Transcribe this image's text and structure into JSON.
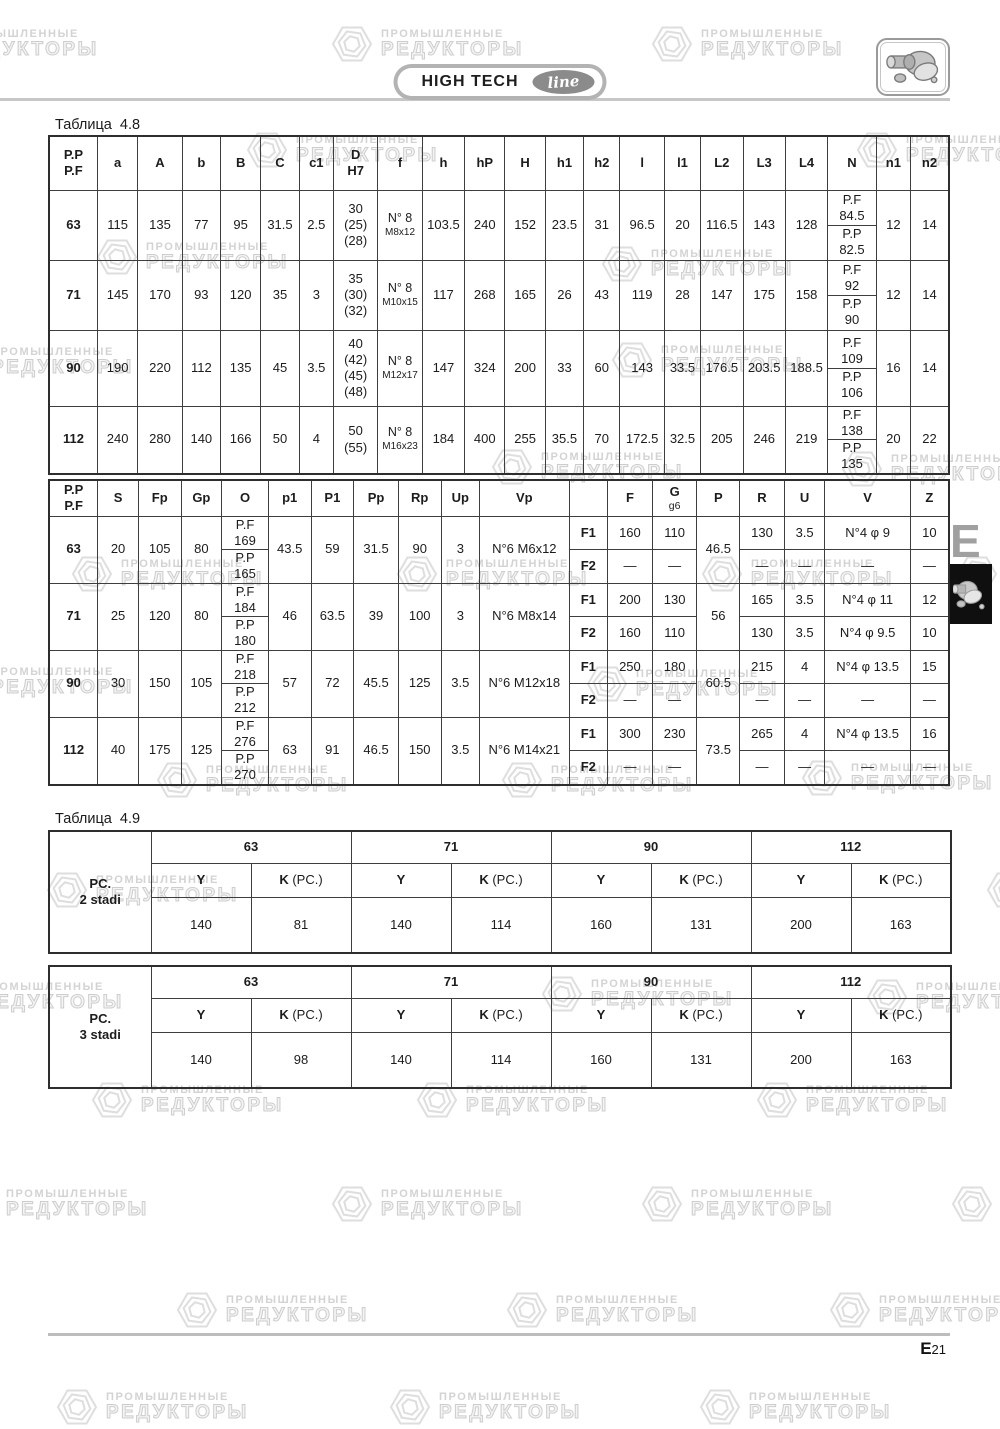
{
  "page": {
    "brand": {
      "title": "HIGH TECH",
      "script": "line"
    },
    "side_tab": {
      "letter": "E"
    },
    "footer": {
      "page_letter": "E",
      "page_number": "21"
    },
    "watermark": {
      "line1": "ПРОМЫШЛЕННЫЕ",
      "line2": "РЕДУКТОРЫ"
    }
  },
  "table48": {
    "label": "Таблица  4.8",
    "headers": [
      "P.P\nP.F",
      "a",
      "A",
      "b",
      "B",
      "C",
      "c1",
      "D\nH7",
      "f",
      "h",
      "hP",
      "H",
      "h1",
      "h2",
      "l",
      "l1",
      "L2",
      "L3",
      "L4",
      "N",
      "n1",
      "n2"
    ],
    "rows": [
      {
        "size": "63",
        "a": "115",
        "A": "135",
        "b": "77",
        "B": "95",
        "C": "31.5",
        "c1": "2.5",
        "D": "30\n(25)\n(28)",
        "f_main": "N° 8",
        "f_sub": "M8x12",
        "h": "103.5",
        "hP": "240",
        "H": "152",
        "h1": "23.5",
        "h2": "31",
        "l": "96.5",
        "l1": "20",
        "L2": "116.5",
        "L3": "143",
        "L4": "128",
        "N_top": "P.F\n84.5",
        "N_bottom": "P.P\n82.5",
        "n1": "12",
        "n2": "14"
      },
      {
        "size": "71",
        "a": "145",
        "A": "170",
        "b": "93",
        "B": "120",
        "C": "35",
        "c1": "3",
        "D": "35\n(30)\n(32)",
        "f_main": "N° 8",
        "f_sub": "M10x15",
        "h": "117",
        "hP": "268",
        "H": "165",
        "h1": "26",
        "h2": "43",
        "l": "119",
        "l1": "28",
        "L2": "147",
        "L3": "175",
        "L4": "158",
        "N_top": "P.F\n92",
        "N_bottom": "P.P\n90",
        "n1": "12",
        "n2": "14"
      },
      {
        "size": "90",
        "a": "190",
        "A": "220",
        "b": "112",
        "B": "135",
        "C": "45",
        "c1": "3.5",
        "D": "40\n(42)\n(45)\n(48)",
        "f_main": "N° 8",
        "f_sub": "M12x17",
        "h": "147",
        "hP": "324",
        "H": "200",
        "h1": "33",
        "h2": "60",
        "l": "143",
        "l1": "33.5",
        "L2": "176.5",
        "L3": "203.5",
        "L4": "188.5",
        "N_top": "P.F\n109",
        "N_bottom": "P.P\n106",
        "n1": "16",
        "n2": "14"
      },
      {
        "size": "112",
        "a": "240",
        "A": "280",
        "b": "140",
        "B": "166",
        "C": "50",
        "c1": "4",
        "D": "50\n(55)",
        "f_main": "N° 8",
        "f_sub": "M16x23",
        "h": "184",
        "hP": "400",
        "H": "255",
        "h1": "35.5",
        "h2": "70",
        "l": "172.5",
        "l1": "32.5",
        "L2": "205",
        "L3": "246",
        "L4": "219",
        "N_top": "P.F\n138",
        "N_bottom": "P.P\n135",
        "n1": "20",
        "n2": "22"
      }
    ]
  },
  "table48b": {
    "headers": [
      "P.P\nP.F",
      "S",
      "Fp",
      "Gp",
      "O",
      "p1",
      "P1",
      "Pp",
      "Rp",
      "Up",
      "Vp",
      "",
      "F",
      "G\ng6",
      "P",
      "R",
      "U",
      "V",
      "Z"
    ],
    "rows": [
      {
        "size": "63",
        "S": "20",
        "Fp": "105",
        "Gp": "80",
        "O_top": "P.F\n169",
        "O_bottom": "P.P\n165",
        "p1": "43.5",
        "P1": "59",
        "Pp": "31.5",
        "Rp": "90",
        "Up": "3",
        "Vp": "N°6 M6x12",
        "P": "46.5",
        "F1": {
          "label": "F1",
          "F": "160",
          "G": "110",
          "R": "130",
          "U": "3.5",
          "V": "N°4 φ 9",
          "Z": "10"
        },
        "F2": {
          "label": "F2",
          "F": "—",
          "G": "—",
          "R": "—",
          "U": "—",
          "V": "—",
          "Z": "—"
        }
      },
      {
        "size": "71",
        "S": "25",
        "Fp": "120",
        "Gp": "80",
        "O_top": "P.F\n184",
        "O_bottom": "P.P\n180",
        "p1": "46",
        "P1": "63.5",
        "Pp": "39",
        "Rp": "100",
        "Up": "3",
        "Vp": "N°6 M8x14",
        "P": "56",
        "F1": {
          "label": "F1",
          "F": "200",
          "G": "130",
          "R": "165",
          "U": "3.5",
          "V": "N°4 φ 11",
          "Z": "12"
        },
        "F2": {
          "label": "F2",
          "F": "160",
          "G": "110",
          "R": "130",
          "U": "3.5",
          "V": "N°4 φ 9.5",
          "Z": "10"
        }
      },
      {
        "size": "90",
        "S": "30",
        "Fp": "150",
        "Gp": "105",
        "O_top": "P.F\n218",
        "O_bottom": "P.P\n212",
        "p1": "57",
        "P1": "72",
        "Pp": "45.5",
        "Rp": "125",
        "Up": "3.5",
        "Vp": "N°6 M12x18",
        "P": "60.5",
        "F1": {
          "label": "F1",
          "F": "250",
          "G": "180",
          "R": "215",
          "U": "4",
          "V": "N°4 φ 13.5",
          "Z": "15"
        },
        "F2": {
          "label": "F2",
          "F": "—",
          "G": "—",
          "R": "—",
          "U": "—",
          "V": "—",
          "Z": "—"
        }
      },
      {
        "size": "112",
        "S": "40",
        "Fp": "175",
        "Gp": "125",
        "O_top": "P.F\n276",
        "O_bottom": "P.P\n270",
        "p1": "63",
        "P1": "91",
        "Pp": "46.5",
        "Rp": "150",
        "Up": "3.5",
        "Vp": "N°6 M14x21",
        "P": "73.5",
        "F1": {
          "label": "F1",
          "F": "300",
          "G": "230",
          "R": "265",
          "U": "4",
          "V": "N°4 φ 13.5",
          "Z": "16"
        },
        "F2": {
          "label": "F2",
          "F": "—",
          "G": "—",
          "R": "—",
          "U": "—",
          "V": "—",
          "Z": "—"
        }
      }
    ]
  },
  "table49": {
    "label": "Таблица  4.9",
    "sizes": [
      "63",
      "71",
      "90",
      "112"
    ],
    "col_y": "Y",
    "col_k": "K",
    "col_k_note": "(PC.)",
    "blocks": [
      {
        "name": "PC.\n2 stadi",
        "values": [
          [
            "140",
            "81"
          ],
          [
            "140",
            "114"
          ],
          [
            "160",
            "131"
          ],
          [
            "200",
            "163"
          ]
        ]
      },
      {
        "name": "PC.\n3 stadi",
        "values": [
          [
            "140",
            "98"
          ],
          [
            "140",
            "114"
          ],
          [
            "160",
            "131"
          ],
          [
            "200",
            "163"
          ]
        ]
      }
    ]
  }
}
